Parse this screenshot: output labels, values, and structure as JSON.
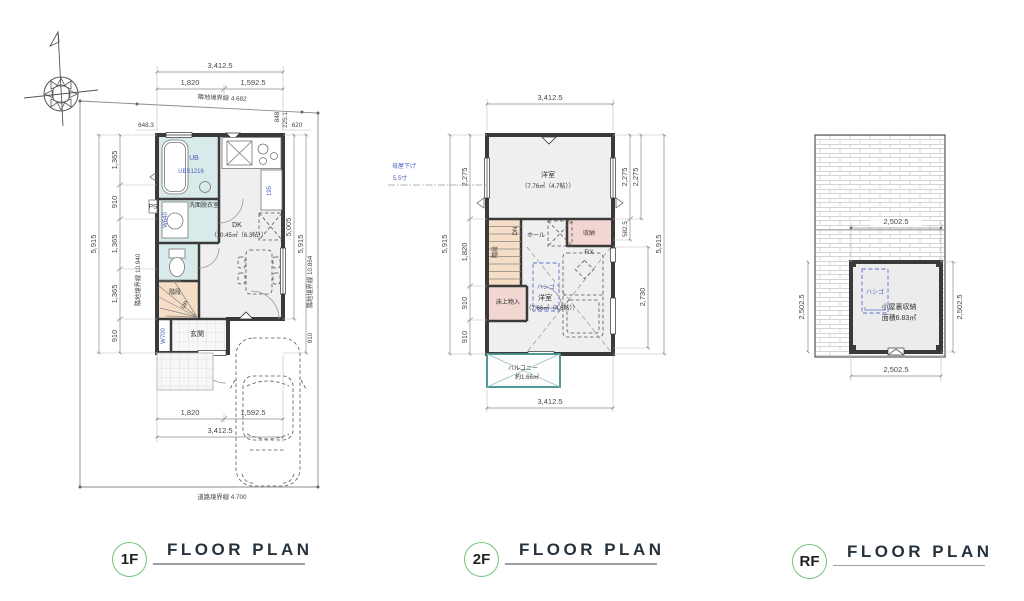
{
  "colors": {
    "accent_green": "#76c47c",
    "wall": "#3a3a3a",
    "wet_room": "#d9eaea",
    "stairs": "#f6ddc6",
    "storage_pink": "#f2d6d2",
    "balcony_teal": "#3f8d8d",
    "annotation_blue": "#4a5fc1",
    "title_text": "#26323e"
  },
  "titles": {
    "f1": {
      "badge": "1F",
      "label": "FLOOR PLAN"
    },
    "f2": {
      "badge": "2F",
      "label": "FLOOR PLAN"
    },
    "rf": {
      "badge": "RF",
      "label": "FLOOR PLAN"
    }
  },
  "f1": {
    "dims": {
      "top_total": "3,412.5",
      "top_left": "1,820",
      "top_right": "1,592.5",
      "boundary_top": "隣地境界線 4.682",
      "offset_left": "648.3",
      "offset_right": "620",
      "v_848": "848",
      "v_225": "225.1",
      "left_outer": "5,915",
      "left_segs": [
        "1,365",
        "910",
        "1,365",
        "1,365",
        "910"
      ],
      "boundary_left": "隣地境界線 10.940",
      "right_5005": "5,005",
      "right_outer": "5,915",
      "boundary_right": "隣地境界線 10.864",
      "right_910": "910",
      "bottom_left": "1,820",
      "bottom_right": "1,592.5",
      "bottom_total": "3,412.5",
      "boundary_bottom": "道路境界線 4.700"
    },
    "rooms": {
      "ub": "UB",
      "ub_model": "UBS1216",
      "washroom": "洗面脱衣室",
      "washer": "W640",
      "ps": "PS",
      "fridge_w": "195",
      "dk": "DK",
      "dk_area": "（10.45㎡（6.3帖））",
      "stairs": "階段",
      "up": "UP",
      "shoe_closet": "W700",
      "entrance": "玄関"
    }
  },
  "f2": {
    "dims": {
      "top_total": "3,412.5",
      "bottom_total": "3,412.5",
      "left_outer": "5,915",
      "left_segs": [
        "2,275",
        "1,820",
        "910",
        "910"
      ],
      "right_2275_a": "2,275",
      "right_2275_b": "2,275",
      "right_582": "582.5",
      "right_2730": "2,730",
      "right_outer": "5,915",
      "moya_line1": "母屋下げ",
      "moya_line2": "5.5寸"
    },
    "rooms": {
      "room1": "洋室",
      "room1_area": "（7.76㎡（4.7帖））",
      "hall": "ホール",
      "closet": "収納",
      "fix": "FIX",
      "stairs": "階段",
      "dn": "DN",
      "floor_storage": "床上物入",
      "room2": "洋室",
      "room2_area": "（7.66㎡（4.6帖））",
      "ladder": "ハシゴ",
      "balcony": "バルコニー",
      "balcony_area": "約1.66㎡"
    }
  },
  "rf": {
    "dims": {
      "top": "2,502.5",
      "left": "2,502.5",
      "right": "2,502.5",
      "bottom": "2,502.5"
    },
    "rooms": {
      "attic": "小屋裏収納",
      "attic_area": "面積6.83㎡",
      "ladder": "ハシゴ"
    }
  }
}
